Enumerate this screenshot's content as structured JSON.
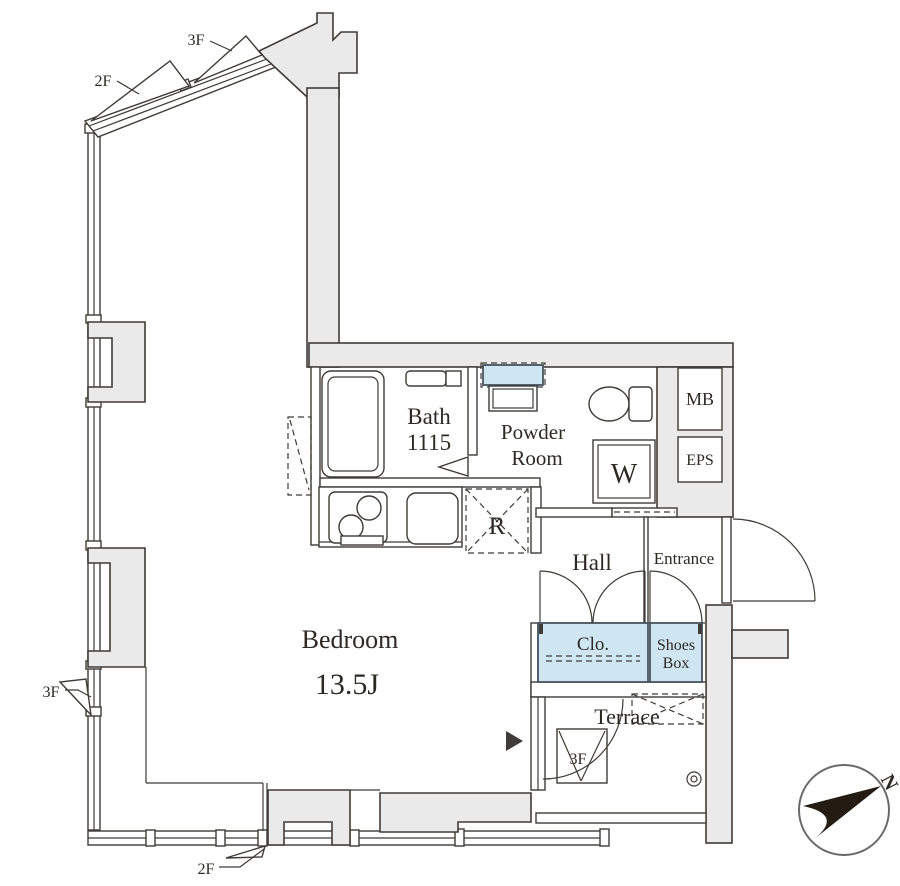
{
  "plan": {
    "rooms": {
      "bedroom": {
        "label": "Bedroom",
        "area": "13.5J"
      },
      "bath": {
        "label": "Bath",
        "size": "1115"
      },
      "powder_room": {
        "line1": "Powder",
        "line2": "Room"
      },
      "hall": {
        "label": "Hall"
      },
      "entrance": {
        "label": "Entrance"
      },
      "closet": {
        "label": "Clo."
      },
      "shoes_box": {
        "line1": "Shoes",
        "line2": "Box"
      },
      "terrace": {
        "label": "Terrace"
      }
    },
    "fixtures": {
      "washing_machine": "W",
      "refrigerator": "R",
      "meter_box": "MB",
      "eps": "EPS",
      "terrace_hatch": "3F"
    },
    "window_markers": {
      "diagonal_2f": "2F",
      "diagonal_3f": "3F",
      "left_3f": "3F",
      "bottom_2f": "2F"
    },
    "compass": {
      "north": "N"
    },
    "colors": {
      "wall_fill": "#ebeaea",
      "line": "#3f3b38",
      "fitting_blue": "#cfe6f2",
      "compass_black": "#241c13"
    }
  }
}
